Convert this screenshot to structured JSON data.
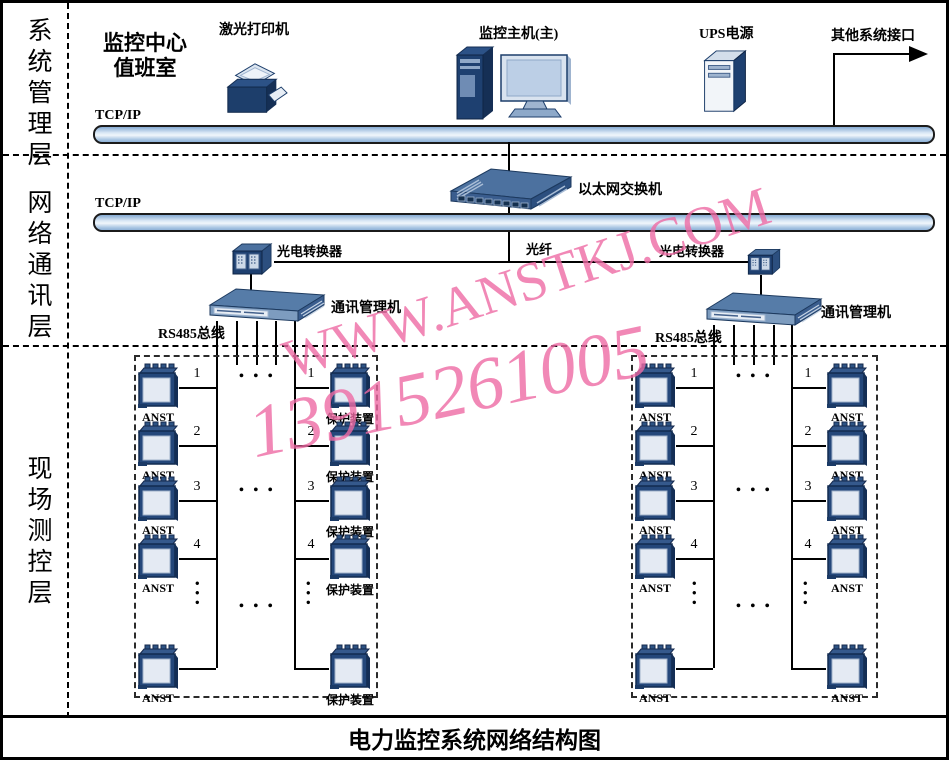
{
  "watermark": {
    "line1": "WWW.ANSTKJ.COM",
    "line2": "13915261005",
    "color": "#ee6aa4"
  },
  "layers": {
    "system": "系统管理层",
    "network": "网络通讯层",
    "field": "现场测控层"
  },
  "system_layer": {
    "room_line1": "监控中心",
    "room_line2": "值班室",
    "printer_label": "激光打印机",
    "host_label": "监控主机(主)",
    "ups_label": "UPS电源",
    "other_label": "其他系统接口",
    "bus_label": "TCP/IP"
  },
  "network_layer": {
    "bus_label": "TCP/IP",
    "switch_label": "以太网交换机",
    "fiber_label": "光纤",
    "converter_left_label": "光电转换器",
    "converter_right_label": "光电转换器",
    "comm_left_label": "通讯管理机",
    "comm_right_label": "通讯管理机",
    "rs485_left_label": "RS485总线",
    "rs485_right_label": "RS485总线"
  },
  "field_layer": {
    "ellipsis_h": "• • •",
    "ellipsis_v": "•••",
    "boxes": [
      {
        "columns": [
          {
            "rows": [
              {
                "n": "1",
                "label": "ANST"
              },
              {
                "n": "2",
                "label": "ANST"
              },
              {
                "n": "3",
                "label": "ANST"
              },
              {
                "n": "4",
                "label": "ANST"
              },
              {
                "n": "",
                "label": "ANST"
              }
            ]
          },
          {
            "rows": [
              {
                "n": "1",
                "label": "保护装置"
              },
              {
                "n": "2",
                "label": "保护装置"
              },
              {
                "n": "3",
                "label": "保护装置"
              },
              {
                "n": "4",
                "label": "保护装置"
              },
              {
                "n": "",
                "label": "保护装置"
              }
            ]
          }
        ]
      },
      {
        "columns": [
          {
            "rows": [
              {
                "n": "1",
                "label": "ANST"
              },
              {
                "n": "2",
                "label": "ANST"
              },
              {
                "n": "3",
                "label": "ANST"
              },
              {
                "n": "4",
                "label": "ANST"
              },
              {
                "n": "",
                "label": "ANST"
              }
            ]
          },
          {
            "rows": [
              {
                "n": "1",
                "label": "ANST"
              },
              {
                "n": "2",
                "label": "ANST"
              },
              {
                "n": "3",
                "label": "ANST"
              },
              {
                "n": "4",
                "label": "ANST"
              },
              {
                "n": "",
                "label": "ANST"
              }
            ]
          }
        ]
      }
    ]
  },
  "footer": {
    "title": "电力监控系统网络结构图"
  }
}
